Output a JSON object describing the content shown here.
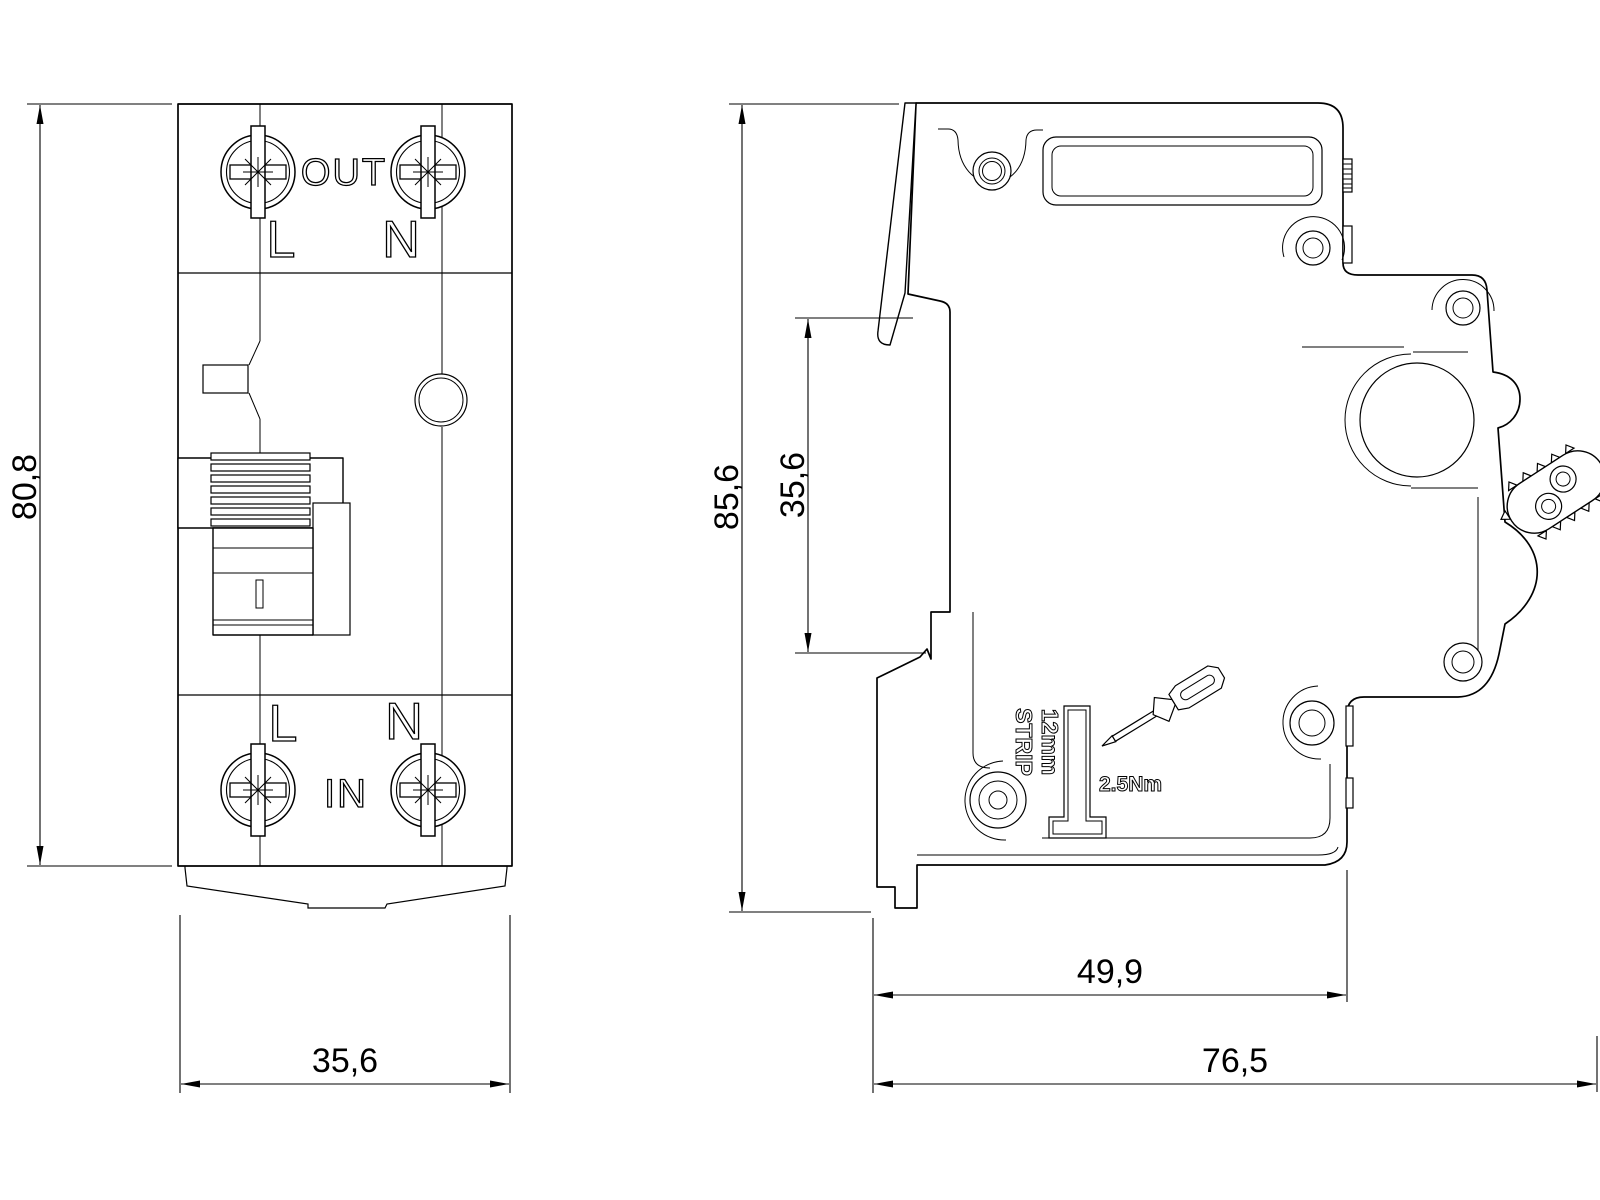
{
  "front_view": {
    "top_terminal": {
      "label": "OUT",
      "pole_left": "L",
      "pole_right": "N"
    },
    "bottom_terminal": {
      "label": "IN",
      "pole_left": "L",
      "pole_right": "N"
    },
    "dimensions": {
      "height": "80,8",
      "width": "35,6"
    }
  },
  "side_view": {
    "dimensions": {
      "height": "85,6",
      "terminal_cutout": "35,6",
      "body_depth": "49,9",
      "overall_depth": "76,5"
    },
    "strip_gauge": {
      "line1": "12mm",
      "line2": "STRIP"
    },
    "torque": "2.5Nm"
  },
  "icons": {
    "terminal_screw": "phillips-screw-icon",
    "tool": "screwdriver-icon",
    "actuator": "toggle-lever-icon"
  },
  "colors": {
    "line": "#000000",
    "background": "#ffffff"
  }
}
